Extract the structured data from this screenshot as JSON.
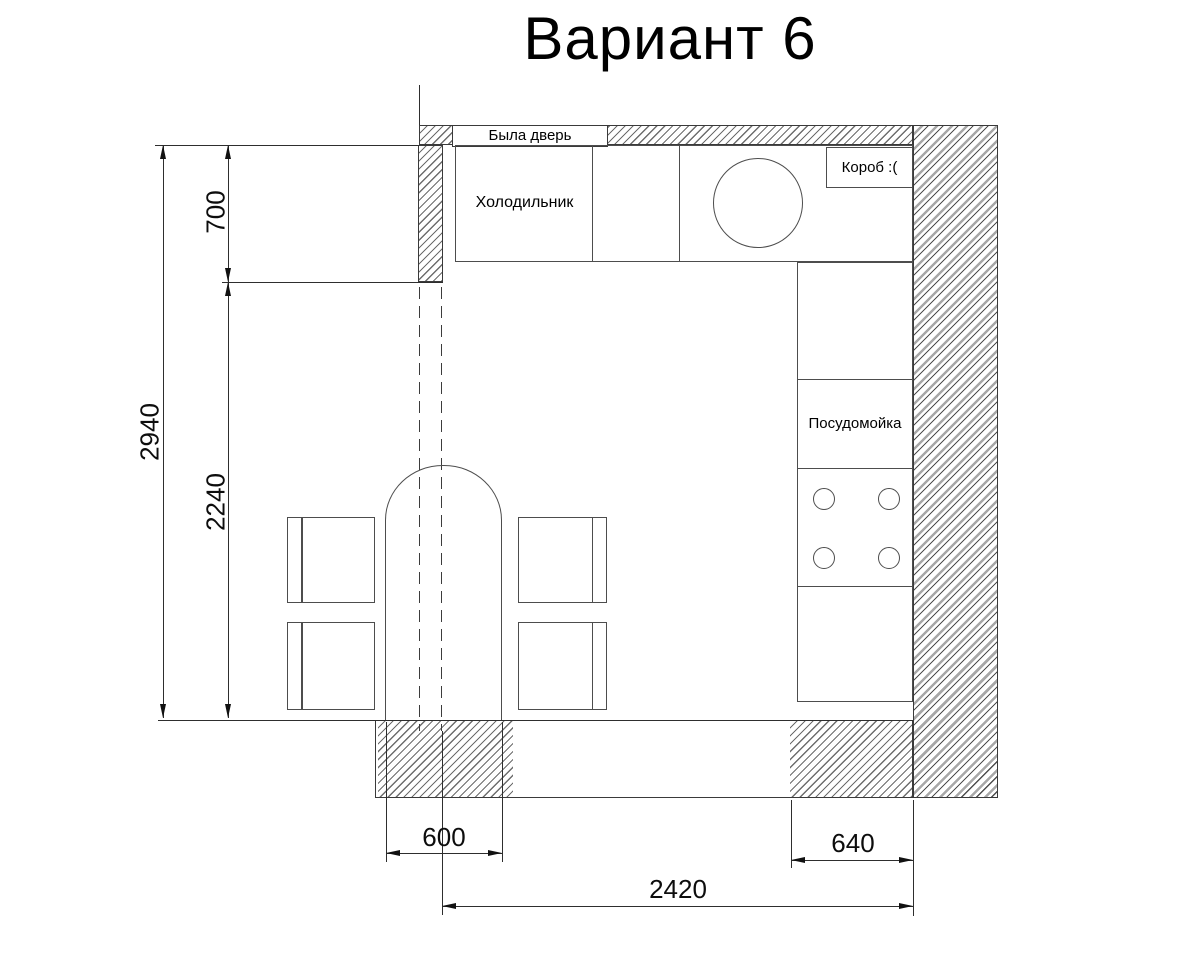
{
  "title": "Вариант 6",
  "plan": {
    "door_was_label": "Была дверь",
    "fridge_label": "Холодильник",
    "duct_label": "Короб :(",
    "dishwasher_label": "Посудомойка"
  },
  "dimensions": {
    "total_height": "2940",
    "top_wall_offset": "700",
    "open_span": "2240",
    "doorway_width": "600",
    "counter_depth": "640",
    "total_width": "2420"
  },
  "colors": {
    "background": "#ffffff",
    "line": "#3a3a3a",
    "hatch": "#6d6d6d",
    "text": "#000000"
  }
}
